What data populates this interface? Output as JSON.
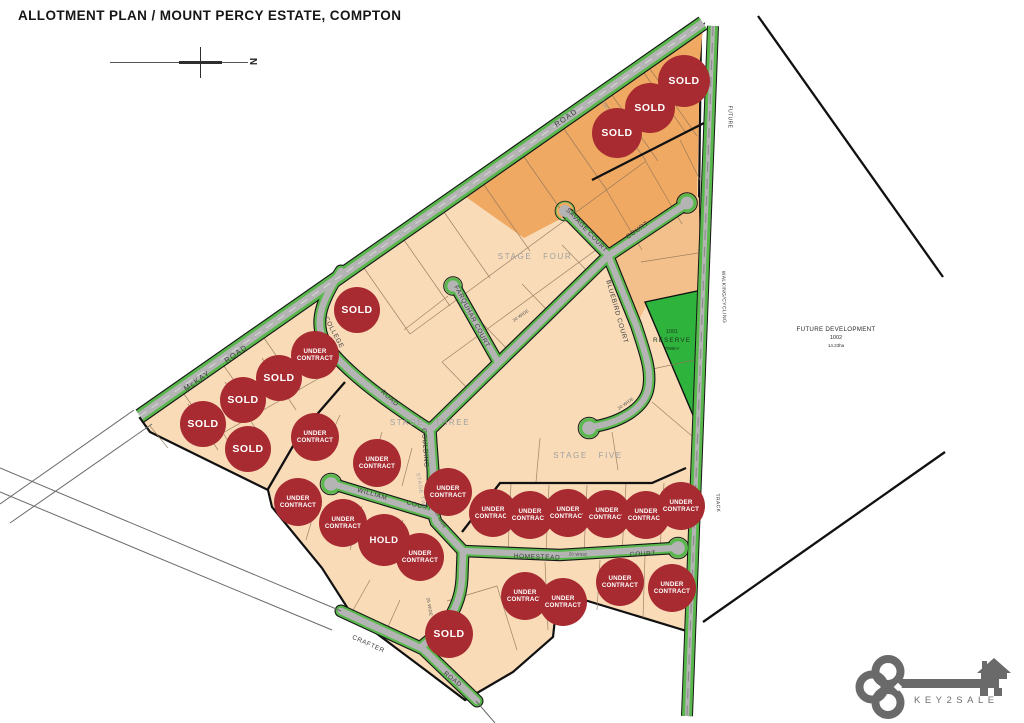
{
  "title": "ALLOTMENT PLAN / MOUNT PERCY ESTATE, COMPTON",
  "compass": {
    "north_label": "N"
  },
  "map": {
    "colors": {
      "badge": "#a82b31",
      "road_green": "#58b84b",
      "reserve_green": "#2eb33c",
      "lot_base": "#f9dbb8",
      "lot_dark": "#efa963",
      "lot_medium": "#f3c08b"
    },
    "road_labels": [
      {
        "text": "McKAY",
        "x": 197,
        "y": 381,
        "rot": -35,
        "cls": "main"
      },
      {
        "text": "ROAD",
        "x": 236,
        "y": 354,
        "rot": -35,
        "cls": "main"
      },
      {
        "text": "ROAD",
        "x": 566,
        "y": 118,
        "rot": -35,
        "cls": "main"
      },
      {
        "text": "COLLEGE",
        "x": 333,
        "y": 333,
        "rot": 62,
        "cls": "road"
      },
      {
        "text": "ROAD",
        "x": 389,
        "y": 399,
        "rot": 42,
        "cls": "road"
      },
      {
        "text": "SAVAGE COURT",
        "x": 586,
        "y": 231,
        "rot": 47,
        "cls": "road"
      },
      {
        "text": "COURT",
        "x": 638,
        "y": 231,
        "rot": -35,
        "cls": "road"
      },
      {
        "text": "FARQUHAR COURT",
        "x": 471,
        "y": 317,
        "rot": 62,
        "cls": "road"
      },
      {
        "text": "BLUEBIRD COURT",
        "x": 616,
        "y": 312,
        "rot": 74,
        "cls": "road"
      },
      {
        "text": "GOULDING",
        "x": 424,
        "y": 448,
        "rot": 86,
        "cls": "road"
      },
      {
        "text": "WILLIAM",
        "x": 372,
        "y": 495,
        "rot": 16,
        "cls": "road"
      },
      {
        "text": "COURT",
        "x": 419,
        "y": 507,
        "rot": 16,
        "cls": "road"
      },
      {
        "text": "HOMESTEAD",
        "x": 537,
        "y": 558,
        "rot": 2,
        "cls": "road"
      },
      {
        "text": "COURT",
        "x": 643,
        "y": 555,
        "rot": -3,
        "cls": "road"
      },
      {
        "text": "CRAFTER",
        "x": 368,
        "y": 645,
        "rot": 24,
        "cls": "road"
      },
      {
        "text": "ROAD",
        "x": 452,
        "y": 680,
        "rot": 38,
        "cls": "road"
      },
      {
        "text": "FUTURE",
        "x": 729,
        "y": 117,
        "rot": 90,
        "cls": "track"
      },
      {
        "text": "WALKING/CYCLING",
        "x": 723,
        "y": 297,
        "rot": 89,
        "cls": "track"
      },
      {
        "text": "TRACK",
        "x": 717,
        "y": 503,
        "rot": 87,
        "cls": "track"
      }
    ],
    "width_labels": [
      {
        "text": "20 WIDE",
        "x": 521,
        "y": 316,
        "rot": -35
      },
      {
        "text": "20 WIDE",
        "x": 626,
        "y": 404,
        "rot": -35
      },
      {
        "text": "30 WIDE",
        "x": 440,
        "y": 520,
        "rot": 60
      },
      {
        "text": "20 WIDE",
        "x": 578,
        "y": 555,
        "rot": 2
      },
      {
        "text": "25 WIDE",
        "x": 429,
        "y": 607,
        "rot": 80
      }
    ],
    "stage_labels": [
      {
        "text": "STAGE FOUR",
        "x": 535,
        "y": 257,
        "rot": 0,
        "small": false
      },
      {
        "text": "STAGE THREE",
        "x": 430,
        "y": 423,
        "rot": 0,
        "small": false
      },
      {
        "text": "STAGE FIVE",
        "x": 588,
        "y": 456,
        "rot": 0,
        "small": false
      },
      {
        "text": "STAGE TWO",
        "x": 420,
        "y": 492,
        "rot": 80,
        "small": true
      },
      {
        "text": "STAGE ONE",
        "x": 454,
        "y": 631,
        "rot": -38,
        "small": true
      },
      {
        "text": "STAGE SIX",
        "x": 608,
        "y": 113,
        "rot": 58,
        "small": true
      }
    ],
    "reserve": {
      "lot": "1001",
      "name": "RESERVE",
      "area": "7999m²",
      "x": 672,
      "y": 340
    },
    "future_development": {
      "line1": "FUTURE DEVELOPMENT",
      "line2": "1002",
      "line3": "14.23ha",
      "x": 836,
      "y": 337
    },
    "badges": [
      {
        "label": "SOLD",
        "x": 684,
        "y": 81,
        "r": 26
      },
      {
        "label": "SOLD",
        "x": 650,
        "y": 108,
        "r": 25
      },
      {
        "label": "SOLD",
        "x": 617,
        "y": 133,
        "r": 25
      },
      {
        "label": "SOLD",
        "x": 357,
        "y": 310,
        "r": 23
      },
      {
        "label": "SOLD",
        "x": 279,
        "y": 378,
        "r": 23
      },
      {
        "label": "SOLD",
        "x": 243,
        "y": 400,
        "r": 23
      },
      {
        "label": "SOLD",
        "x": 203,
        "y": 424,
        "r": 23
      },
      {
        "label": "SOLD",
        "x": 248,
        "y": 449,
        "r": 23
      },
      {
        "label": "SOLD",
        "x": 449,
        "y": 634,
        "r": 24
      },
      {
        "label": "UNDER CONTRACT",
        "x": 315,
        "y": 355,
        "r": 24
      },
      {
        "label": "UNDER CONTRACT",
        "x": 315,
        "y": 437,
        "r": 24
      },
      {
        "label": "UNDER CONTRACT",
        "x": 377,
        "y": 463,
        "r": 24
      },
      {
        "label": "UNDER CONTRACT",
        "x": 448,
        "y": 492,
        "r": 24
      },
      {
        "label": "UNDER CONTRACT",
        "x": 298,
        "y": 502,
        "r": 24
      },
      {
        "label": "UNDER CONTRACT",
        "x": 343,
        "y": 523,
        "r": 24
      },
      {
        "label": "UNDER CONTRACT",
        "x": 420,
        "y": 557,
        "r": 24
      },
      {
        "label": "HOLD",
        "x": 384,
        "y": 540,
        "r": 26
      },
      {
        "label": "UNDER CONTRACT",
        "x": 493,
        "y": 513,
        "r": 24
      },
      {
        "label": "UNDER CONTRACT",
        "x": 530,
        "y": 515,
        "r": 24
      },
      {
        "label": "UNDER CONTRACT",
        "x": 568,
        "y": 513,
        "r": 24
      },
      {
        "label": "UNDER CONTRACT",
        "x": 607,
        "y": 514,
        "r": 24
      },
      {
        "label": "UNDER CONTRACT",
        "x": 646,
        "y": 515,
        "r": 24
      },
      {
        "label": "UNDER CONTRACT",
        "x": 681,
        "y": 506,
        "r": 24
      },
      {
        "label": "UNDER CONTRACT",
        "x": 525,
        "y": 596,
        "r": 24
      },
      {
        "label": "UNDER CONTRACT",
        "x": 563,
        "y": 602,
        "r": 24
      },
      {
        "label": "UNDER CONTRACT",
        "x": 620,
        "y": 582,
        "r": 24
      },
      {
        "label": "UNDER CONTRACT",
        "x": 672,
        "y": 588,
        "r": 24
      }
    ]
  },
  "logo": {
    "brand": "KEY2SALE"
  }
}
